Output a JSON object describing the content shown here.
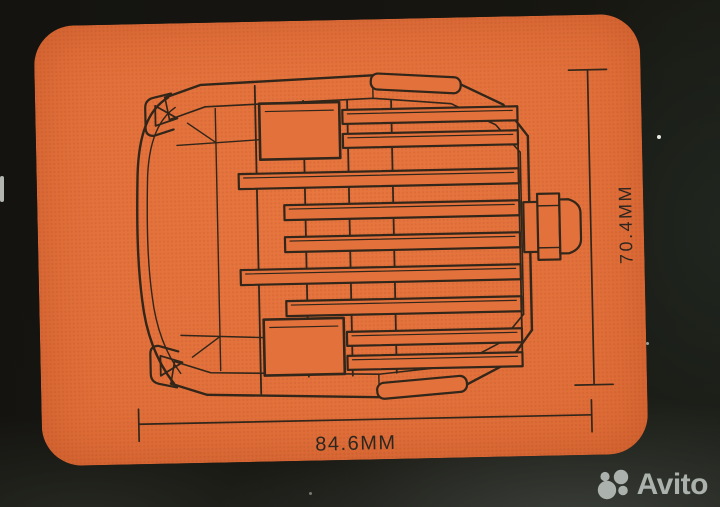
{
  "photo": {
    "background_color": "#151410",
    "watermark": {
      "brand": "Avito",
      "color": "#b5bbb6"
    }
  },
  "card": {
    "color": "#e3713c",
    "line_color": "#312619",
    "shape": "rounded-rectangle"
  },
  "diagram": {
    "subject": "led-work-light-rear-view",
    "width_label": "84.6MM",
    "height_label": "70.4MM"
  }
}
